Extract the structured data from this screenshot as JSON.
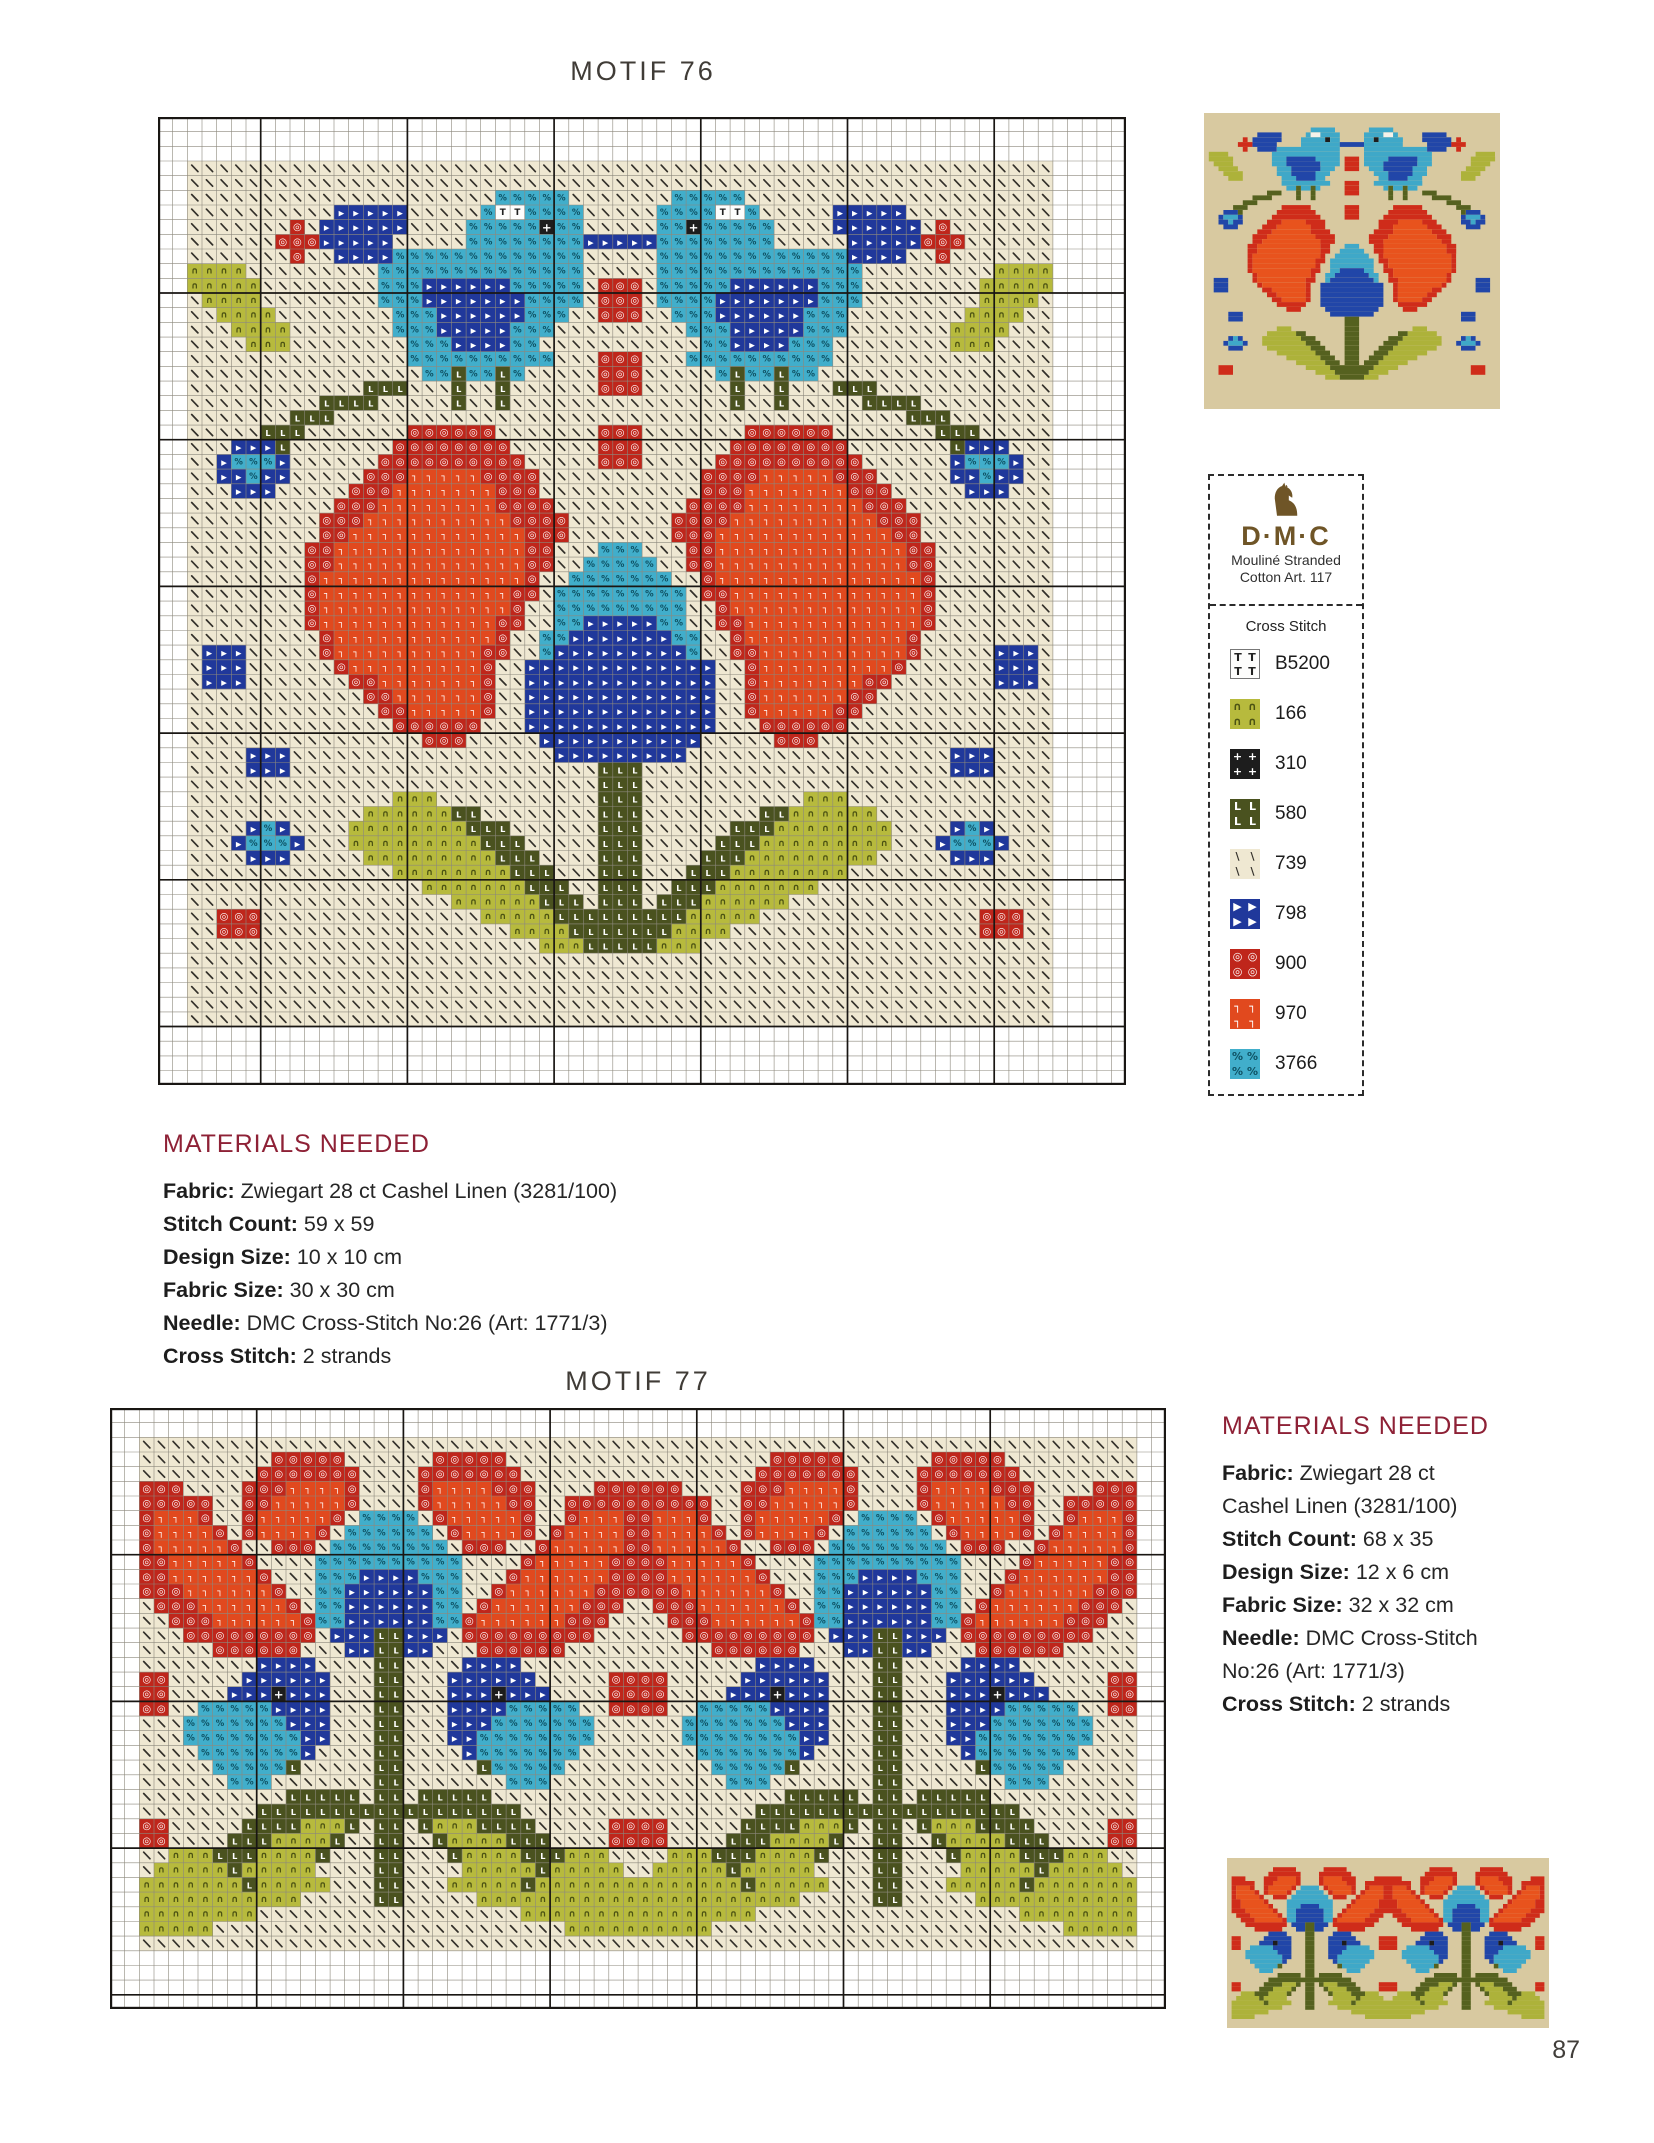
{
  "page": {
    "number": "87"
  },
  "motif76": {
    "title": "MOTIF 76",
    "materials": {
      "heading": "MATERIALS NEEDED",
      "lines": [
        {
          "label": "Fabric:",
          "value": " Zwiegart 28 ct Cashel Linen (3281/100)"
        },
        {
          "label": "Stitch Count:",
          "value": " 59 x 59"
        },
        {
          "label": "Design Size:",
          "value": " 10 x 10 cm"
        },
        {
          "label": "Fabric Size:",
          "value": " 30 x 30 cm"
        },
        {
          "label": "Needle:",
          "value": " DMC Cross-Stitch No:26 (Art: 1771/3)"
        },
        {
          "label": "Cross Stitch:",
          "value": " 2 strands"
        }
      ]
    }
  },
  "motif77": {
    "title": "MOTIF 77",
    "materials": {
      "heading": "MATERIALS NEEDED",
      "lines": [
        {
          "label": "Fabric:",
          "value": " Zwiegart 28 ct"
        },
        {
          "label": "",
          "value": "Cashel Linen (3281/100)"
        },
        {
          "label": "Stitch Count:",
          "value": " 68 x 35"
        },
        {
          "label": "Design Size:",
          "value": " 12 x 6 cm"
        },
        {
          "label": "Fabric Size:",
          "value": " 32 x 32 cm"
        },
        {
          "label": "Needle:",
          "value": " DMC Cross-Stitch"
        },
        {
          "label": "",
          "value": "No:26 (Art: 1771/3)"
        },
        {
          "label": "Cross Stitch:",
          "value": " 2 strands"
        }
      ]
    }
  },
  "dmc_legend": {
    "brand": "D·M·C",
    "subtitle1": "Mouliné Stranded",
    "subtitle2": "Cotton Art. 117",
    "section": "Cross Stitch",
    "logo_color": "#6f5527",
    "entries": [
      {
        "key": "w",
        "code": "B5200"
      },
      {
        "key": "g",
        "code": "166"
      },
      {
        "key": "k",
        "code": "310"
      },
      {
        "key": "d",
        "code": "580"
      },
      {
        "key": "f",
        "code": "739"
      },
      {
        "key": "b",
        "code": "798"
      },
      {
        "key": "r",
        "code": "900"
      },
      {
        "key": "o",
        "code": "970"
      },
      {
        "key": "c",
        "code": "3766"
      }
    ]
  },
  "palette": {
    "f": {
      "dmc": "739",
      "bg": "#efe8d2",
      "previewBg": "#d8c9a0",
      "sym": "\\",
      "symColor": "#33302a",
      "symScale": 0.6
    },
    "w": {
      "dmc": "B5200",
      "bg": "#fdfdfc",
      "previewBg": "#f5f2ea",
      "sym": "T",
      "symColor": "#222222",
      "symScale": 0.6
    },
    "g": {
      "dmc": "166",
      "bg": "#b7ba3d",
      "previewBg": "#adb23a",
      "sym": "∩",
      "symColor": "#4c5313",
      "symScale": 0.62
    },
    "k": {
      "dmc": "310",
      "bg": "#1d1d1d",
      "previewBg": "#1d1d1d",
      "sym": "+",
      "symColor": "#ffffff",
      "symScale": 0.8
    },
    "d": {
      "dmc": "580",
      "bg": "#4a521f",
      "previewBg": "#55611f",
      "sym": "L",
      "symColor": "#ffffff",
      "symScale": 0.56
    },
    "b": {
      "dmc": "798",
      "bg": "#20389b",
      "previewBg": "#2146a8",
      "sym": "▶",
      "symColor": "#ffffff",
      "symScale": 0.5
    },
    "r": {
      "dmc": "900",
      "bg": "#bf261b",
      "previewBg": "#cf2c1a",
      "sym": "◎",
      "symColor": "#ffffff",
      "symScale": 0.68
    },
    "o": {
      "dmc": "970",
      "bg": "#e1491e",
      "previewBg": "#e8531d",
      "sym": "┐",
      "symColor": "#ffffff",
      "symScale": 0.62
    },
    "c": {
      "dmc": "3766",
      "bg": "#41aecb",
      "previewBg": "#3fa8c8",
      "sym": "%",
      "symColor": "#0e5163",
      "symScale": 0.58
    }
  },
  "chart_data": [
    {
      "id": "motif76",
      "type": "heatmap",
      "title": "MOTIF 76",
      "stitch_count": "59 x 59",
      "grid": {
        "cols": 66,
        "rows": 66,
        "margin_left": 2,
        "margin_top": 3,
        "bold_cols": [
          7,
          17,
          27,
          37,
          47,
          57
        ],
        "bold_rows": [
          12,
          22,
          32,
          42,
          52,
          62
        ],
        "mirror": "odd-center",
        "half_rows": [
          "ffffffffffffffffffffffffffffff",
          "ffffffffffffffffffffffffffffff",
          "fffffffffffffffffffffcccccffff",
          "ffffffffffbbbbbfffffcwwccccfff",
          "fffffffrfbbbbbbffffccccckccfff",
          "ffffffrrrbbbbbfffffccccccccbbb",
          "fffffffrffbbbbcccccccccccccfff",
          "ggggfffffffffccccccccccccccfff",
          "gggggffffffffcccbbbbbbcccccfrr",
          "fggggffffffffcccbbbbbbbccccfrr",
          "ffggggffffffffcccbbbbbbcccffrr",
          "fffggggfffffffcccbbbbbcccfffff",
          "ffffgggffffffffcccbbbbccffffff",
          "fffffffffffffffccccccccccfffrr",
          "ffffffffffffffffccdccdcfffffrr",
          "ffffffffffffdddfffdffdffffffrr",
          "fffffffffddddfffffdffdffffffff",
          "fffffffdddffffffffffffffffffff",
          "fffffdddfffffffrrrrrrfffffffrr",
          "fffbbbdfffffffrrrrrrrrffffffrr",
          "ffbcccbffffffrrrrrrrrrrfffffrr",
          "ffbbcbbfffffrrrooooorrrrffffff",
          "fffbbbfffffrrrooooooorrrffffff",
          "ffffffffffrrroooooooorrrrfffff",
          "fffffffffrrroooooooooorrrrffff",
          "fffffffffrroooooooooooorrrffff",
          "ffffffffrrooooooooooooorrfffcc",
          "ffffffffrrooooooooooooorrffccc",
          "ffffffffroooooooooooooorffcccc",
          "ffffffffrooooooooooooorrfccccc",
          "ffffffffrooooooooooooorffccccc",
          "ffffffffroooooooooooorrffccbbb",
          "fffffffffrooooooooooorffccbbbb",
          "fbbbfffffroooooooooorrffcbbbbb",
          "fbbbffffffrooooooooorffbbbbbbb",
          "fbbbfffffffrrooooooorffbbbbbbb",
          "ffffffffffffrroooooorffbbbbbbb",
          "fffffffffffffrrooooorffbbbbbbb",
          "ffffffffffffffrrrrrrfffbbbbbbb",
          "ffffffffffffffffrrrfffffbbbbbb",
          "ffffbbbffffffffffffffffffbbbbb",
          "ffffbbbfffffffffffffffffffffdd",
          "ffffffffffffffffffffffffffffdd",
          "ffffffffffffffgggfffffffffffdd",
          "ffffffffffffggggggddffffffffdd",
          "ffffbcbffffggggggggdddffffffdd",
          "fffbcccbfffgggggggggdddfffffdd",
          "ffffbbbfffffgggggggggdddffffdd",
          "ffffffffffffffggggggggdddfffdd",
          "ffffffffffffffffgggggggdddffdd",
          "ffffffffffffffffffggggggdddfdd",
          "ffrrrfffffffffffffffgggggddddd",
          "ffrrrfffffffffffffffffggggdddd",
          "ffffffffffffffffffffffffgggddd",
          "ffffffffffffffffffffffffffffff",
          "ffffffffffffffffffffffffffffff",
          "ffffffffffffffffffffffffffffff",
          "ffffffffffffffffffffffffffffff",
          "ffffffffffffffffffffffffffffff"
        ]
      }
    },
    {
      "id": "motif77",
      "type": "heatmap",
      "title": "MOTIF 77",
      "stitch_count": "68 x 35",
      "grid": {
        "cols": 72,
        "rows": 41,
        "margin_left": 2,
        "margin_top": 2,
        "bold_cols": [
          10,
          20,
          30,
          40,
          50,
          60
        ],
        "bold_rows": [
          10,
          20,
          30,
          40
        ],
        "mirror": "even-unit",
        "unit_width": 34,
        "repeat": 2,
        "half_unit_rows": [
          "fffffffffffffffff",
          "fffffffffrrrrrfff",
          "ffffffffrrrrrrrff",
          "rrrffffrrroooorff",
          "rrrrrffrrooooorff",
          "rooorffrooooorfcc",
          "roooorfroooorfccc",
          "rooooorffrrrfcccc",
          "rrooooorffffccccc",
          "rroooooorfffcccbb",
          "rrroooooorffccbbb",
          "frrroooooorfccbbb",
          "ffrrroooooorccbbb",
          "fffrrrrrrrrrfbbbd",
          "fffffrrrrrrfffbbd",
          "ffffffffbbbbffffd",
          "rrfffffbbbbbbfffd",
          "rrffffbbbkbbbfffd",
          "rrffcccccbbbbfffd",
          "fffcccccccbbbfffd",
          "fffccccccccbbfffd",
          "ffffcccccccbffffd",
          "fffffcccccdfffffd",
          "ffffffcccfffffffd",
          "ffffffffffdddddfd",
          "ffffffffddddddddd",
          "rrfffffddddgggdfd",
          "rrffffdddggggdffd",
          "ffgggdddggggdfffd",
          "fgggggdgggggffffd",
          "gggggggdgggggfffd",
          "gggggggggggfffffd",
          "ggggggggfffffffff",
          "gggggffffffffffff",
          "fffffffffffffffff"
        ]
      }
    }
  ]
}
